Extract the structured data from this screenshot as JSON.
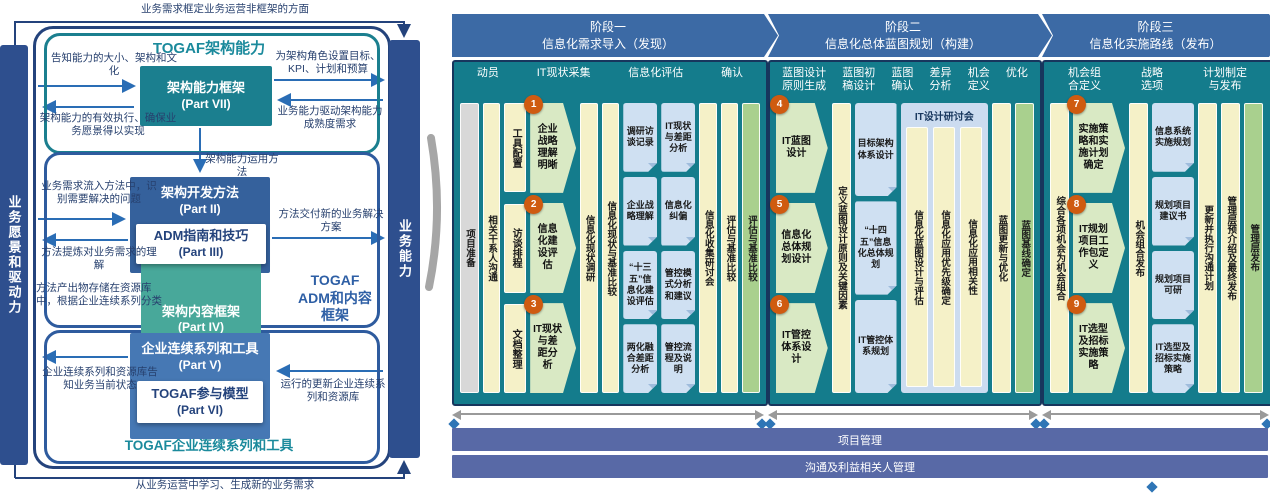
{
  "togaf": {
    "bars": {
      "left": "业务愿景和驱动力",
      "right": "业务能力"
    },
    "titles": {
      "capability": "TOGAF架构能力",
      "adm": "TOGAF\nADM和内容\n框架",
      "continuum": "TOGAF企业连续系列和工具"
    },
    "boxes": {
      "part7": {
        "name": "架构能力框架",
        "part": "(Part VII)"
      },
      "part2": {
        "name": "架构开发方法",
        "part": "(Part II)"
      },
      "part3": {
        "name": "ADM指南和技巧",
        "part": "(Part III)"
      },
      "part4": {
        "name": "架构内容框架",
        "part": "(Part IV)"
      },
      "part5": {
        "name": "企业连续系列和工具",
        "part": "(Part V)"
      },
      "part6": {
        "name": "TOGAF参与模型",
        "part": "(Part VI)"
      }
    },
    "notes": {
      "frame_top": "业务需求框定业务运营非框架的方面",
      "inform_size": "告知能力的大小、架构和文化",
      "set_targets": "为架构角色设置目标、KPI、计划和预算",
      "effective_operation": "架构能力的有效执行、确保业务愿景得以实现",
      "maturity": "业务能力驱动架构能力成熟度需求",
      "operate_method": "架构能力运用方法",
      "need_feeds": "业务需求流入方法中，识别需要解决的问题",
      "delivers_solutions": "方法交付新的业务解决方案",
      "refines_understanding": "方法提炼对业务需求的理解",
      "produces_content": "方法产出物存储在资源库中，根据企业连续系列分类",
      "informs_state": "企业连续系列和资源库告知业务当前状态",
      "updates_continuum": "运行的更新企业连续系列和资源库",
      "learning": "从业务运营中学习、生成新的业务需求"
    }
  },
  "process": {
    "phases": [
      {
        "title": "阶段一\n信息化需求导入（发现）",
        "headers": [
          "动员",
          "IT现状采集",
          "信息化评估",
          "确认"
        ],
        "columns": [
          {
            "type": "vbar",
            "style": "gray",
            "text": "项目准备"
          },
          {
            "type": "vbar",
            "style": "yellow",
            "text": "相关干系人沟通"
          },
          {
            "type": "stack",
            "kind": "tasks",
            "width": 24,
            "items": [
              {
                "text": "工具配置"
              },
              {
                "text": "访谈排程"
              },
              {
                "text": "文档整理"
              }
            ]
          },
          {
            "type": "stack",
            "kind": "steps",
            "width": 50,
            "items": [
              {
                "num": "1",
                "text": "企业战略理解明晰"
              },
              {
                "num": "2",
                "text": "信息化建设评估"
              },
              {
                "num": "3",
                "text": "IT现状与差距分析"
              }
            ]
          },
          {
            "type": "vbar",
            "style": "yellow",
            "text": "信息化现状调研"
          },
          {
            "type": "vbar",
            "style": "yellow",
            "text": "信息化现状与基准比较"
          },
          {
            "type": "stack",
            "kind": "docs",
            "width": 37,
            "items": [
              {
                "text": "调研访谈记录"
              },
              {
                "text": "企业战略理解"
              },
              {
                "text": "“十三五”信息化建设评估"
              },
              {
                "text": "两化融合差距分析"
              }
            ]
          },
          {
            "type": "stack",
            "kind": "docs",
            "width": 37,
            "items": [
              {
                "text": "IT现状与差距分析"
              },
              {
                "text": "信息化纠偏"
              },
              {
                "text": "管控模式分析和建议"
              },
              {
                "text": "管控流程及说明"
              }
            ]
          },
          {
            "type": "vbar",
            "style": "yellow",
            "text": "信息化收集研讨会"
          },
          {
            "type": "vbar",
            "style": "yellow",
            "text": "评估与基准比较"
          },
          {
            "type": "vbar",
            "style": "green",
            "text": "评估与基准比较"
          }
        ]
      },
      {
        "title": "阶段二\n信息化总体蓝图规划（构建）",
        "headers": [
          "蓝图设计\n原则生成",
          "蓝图初\n稿设计",
          "蓝图\n确认",
          "差异\n分析",
          "机会\n定义",
          "优化"
        ],
        "columns": [
          {
            "type": "stack",
            "kind": "steps",
            "width": 52,
            "items": [
              {
                "num": "4",
                "text": "IT蓝图设计"
              },
              {
                "num": "5",
                "text": "信息化总体规划设计"
              },
              {
                "num": "6",
                "text": "IT管控体系设计"
              }
            ]
          },
          {
            "type": "vbar",
            "style": "yellow",
            "text": "定义蓝图设计原则及关键因素"
          },
          {
            "type": "stack",
            "kind": "docs",
            "width": 42,
            "items": [
              {
                "text": "目标架构体系设计"
              },
              {
                "text": "“十四五”信息化总体规划"
              },
              {
                "text": "IT管控体系规划"
              }
            ]
          },
          {
            "type": "workshop",
            "label": "IT设计研讨会",
            "width": 88,
            "bars": [
              "信息化蓝图设计与评估",
              "信息化应用优先级确定",
              "信息化应用相关性"
            ]
          },
          {
            "type": "vbar",
            "style": "yellow",
            "text": "蓝图更新与优化"
          },
          {
            "type": "vbar",
            "style": "green",
            "text": "蓝图基线确定"
          }
        ]
      },
      {
        "title": "阶段三\n信息化实施路线（发布）",
        "headers": [
          "机会组\n合定义",
          "战略\n选项",
          "计划制定\n与发布"
        ],
        "columns": [
          {
            "type": "vbar",
            "style": "yellow",
            "text": "综合各项机会为机会组合"
          },
          {
            "type": "stack",
            "kind": "steps",
            "width": 52,
            "items": [
              {
                "num": "7",
                "text": "实施策略和实施计划确定"
              },
              {
                "num": "8",
                "text": "IT规划项目工作包定义"
              },
              {
                "num": "9",
                "text": "IT选型及招标实施策略"
              }
            ]
          },
          {
            "type": "vbar",
            "style": "yellow",
            "text": "机会组合发布"
          },
          {
            "type": "stack",
            "kind": "docs",
            "width": 42,
            "items": [
              {
                "text": "信息系统实施规划"
              },
              {
                "text": "规划项目建议书"
              },
              {
                "text": "规划项目可研"
              },
              {
                "text": "IT选型及招标实施策略"
              }
            ]
          },
          {
            "type": "vbar",
            "style": "yellow",
            "text": "更新并执行沟通计划"
          },
          {
            "type": "vbar",
            "style": "yellow",
            "text": "管理层预介绍及最终发布"
          },
          {
            "type": "vbar",
            "style": "green",
            "text": "管理层发布"
          }
        ]
      }
    ],
    "bottom_bars": [
      "项目管理",
      "沟通及利益相关人管理"
    ]
  },
  "colors": {
    "navy": "#2e4f8e",
    "teal": "#1b7f8f",
    "band_blue": "#3c6aa5",
    "body_teal": "#147c8c",
    "yellow": "#f5f1c8",
    "green_bar": "#a9d08e",
    "step_green": "#d9e9c4",
    "doc_blue": "#cfe0f2",
    "badge_orange": "#cf5b10",
    "bottom_bar_blue": "#5869a6",
    "diamond_blue": "#2e75b6"
  }
}
